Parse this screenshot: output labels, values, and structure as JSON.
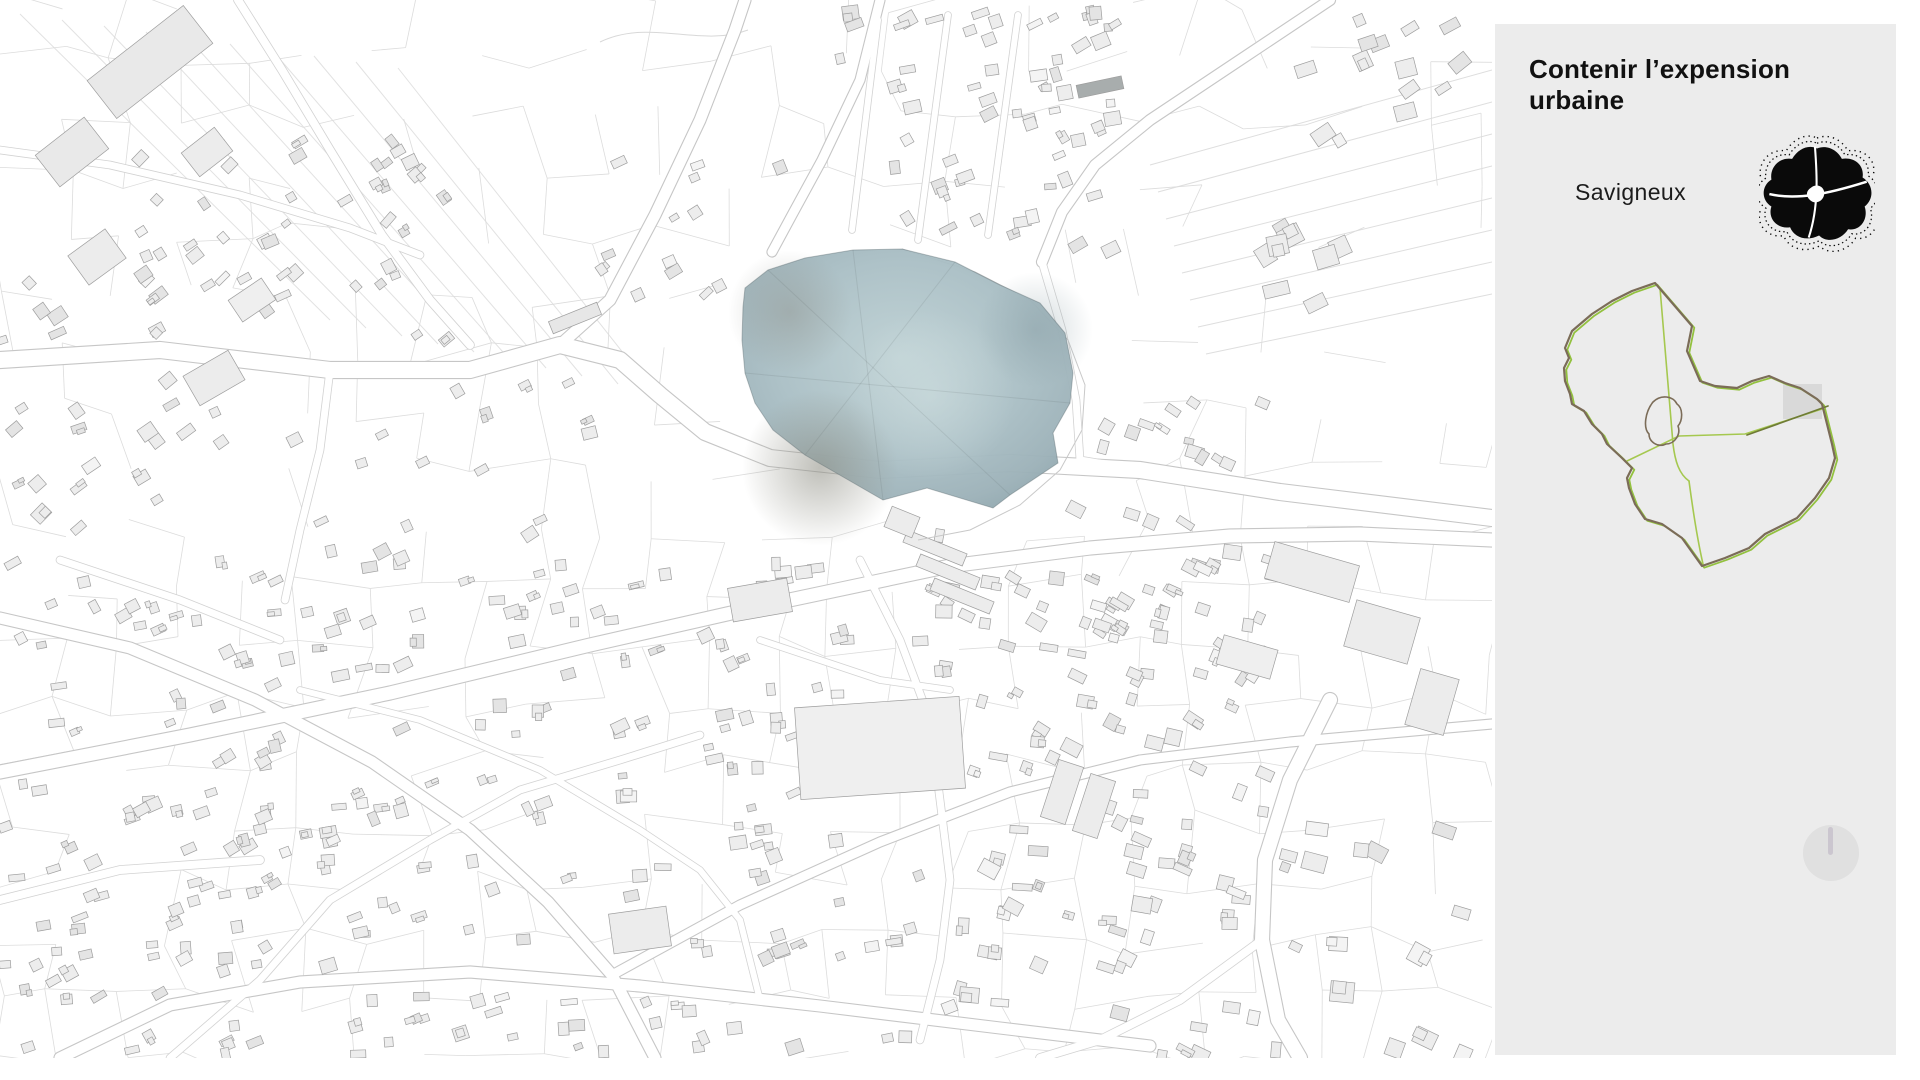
{
  "header": {
    "title": "Contenir l’expension urbaine"
  },
  "commune": {
    "name": "Savigneux"
  },
  "icons": {
    "commune_shape": "commune-contour-icon",
    "dial": "dial-knob-icon"
  },
  "colors": {
    "panel_background": "#ececec",
    "title_text": "#111111",
    "map_background": "#ffffff",
    "parcel_line": "#dcdcdc",
    "building_fill": "#ededed",
    "building_stroke": "#9e9e9e",
    "pond_center": "#b0c5ca",
    "pond_edge": "#8fa6ad",
    "pond_smudge_brown": "#8b8b80",
    "minimap_boundary_brown": "#7b6c58",
    "minimap_boundary_green": "#93c13f",
    "minimap_road_olive": "#6f7b36",
    "minimap_viewport_fill": "#d9d9d9",
    "dial_background": "#e0e0e0",
    "dial_tick": "#cbc6cf"
  }
}
